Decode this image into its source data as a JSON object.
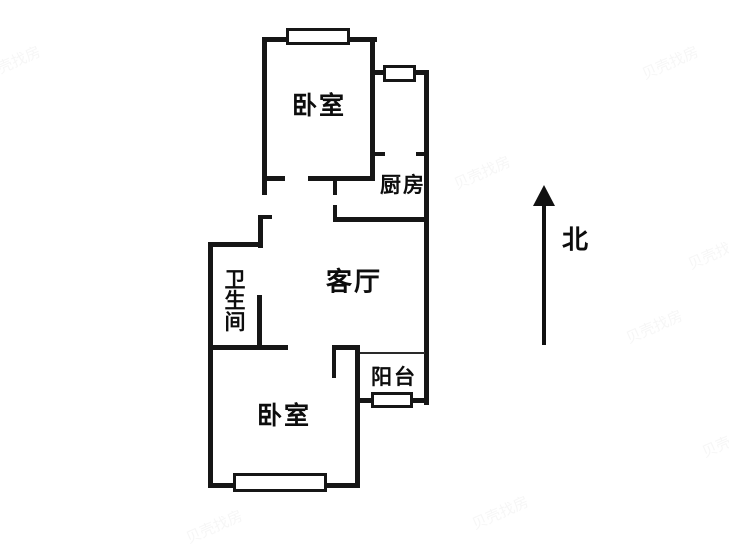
{
  "page": {
    "background_color": "#ffffff",
    "wall_color": "#161616",
    "width": 729,
    "height": 547
  },
  "floorplan": {
    "rooms": [
      {
        "id": "bedroom-north",
        "label": "卧室",
        "cx": 319,
        "cy": 106,
        "font_size": 25,
        "vertical": false
      },
      {
        "id": "kitchen",
        "label": "厨房",
        "cx": 403,
        "cy": 186,
        "font_size": 21,
        "vertical": false
      },
      {
        "id": "living-room",
        "label": "客厅",
        "cx": 354,
        "cy": 282,
        "font_size": 26,
        "vertical": false
      },
      {
        "id": "bathroom",
        "label": "卫生间",
        "cx": 233,
        "cy": 300,
        "font_size": 21,
        "vertical": true
      },
      {
        "id": "balcony",
        "label": "阳台",
        "cx": 394,
        "cy": 378,
        "font_size": 21,
        "vertical": false
      },
      {
        "id": "bedroom-south",
        "label": "卧室",
        "cx": 284,
        "cy": 416,
        "font_size": 25,
        "vertical": false
      }
    ],
    "walls": [
      {
        "x": 262,
        "y": 37,
        "w": 115,
        "h": 5
      },
      {
        "x": 262,
        "y": 37,
        "w": 5,
        "h": 158
      },
      {
        "x": 370,
        "y": 37,
        "w": 5,
        "h": 143
      },
      {
        "x": 372,
        "y": 70,
        "w": 57,
        "h": 5
      },
      {
        "x": 424,
        "y": 70,
        "w": 5,
        "h": 335
      },
      {
        "x": 375,
        "y": 152,
        "w": 10,
        "h": 4
      },
      {
        "x": 416,
        "y": 152,
        "w": 9,
        "h": 4
      },
      {
        "x": 262,
        "y": 176,
        "w": 23,
        "h": 5
      },
      {
        "x": 308,
        "y": 176,
        "w": 67,
        "h": 5
      },
      {
        "x": 333,
        "y": 181,
        "w": 4,
        "h": 14
      },
      {
        "x": 333,
        "y": 217,
        "w": 96,
        "h": 5
      },
      {
        "x": 333,
        "y": 205,
        "w": 4,
        "h": 12
      },
      {
        "x": 258,
        "y": 215,
        "w": 5,
        "h": 33
      },
      {
        "x": 258,
        "y": 215,
        "w": 14,
        "h": 4
      },
      {
        "x": 208,
        "y": 242,
        "w": 55,
        "h": 5
      },
      {
        "x": 208,
        "y": 242,
        "w": 5,
        "h": 246
      },
      {
        "x": 257,
        "y": 295,
        "w": 5,
        "h": 55
      },
      {
        "x": 208,
        "y": 345,
        "w": 80,
        "h": 5
      },
      {
        "x": 332,
        "y": 345,
        "w": 28,
        "h": 5
      },
      {
        "x": 332,
        "y": 350,
        "w": 4,
        "h": 28
      },
      {
        "x": 355,
        "y": 345,
        "w": 5,
        "h": 143
      },
      {
        "x": 355,
        "y": 398,
        "w": 74,
        "h": 5
      },
      {
        "x": 208,
        "y": 483,
        "w": 152,
        "h": 5
      }
    ],
    "thin_lines": [
      {
        "x": 360,
        "y": 352,
        "w": 65,
        "h": 2
      }
    ],
    "windows": [
      {
        "id": "window-bedroom-north",
        "x": 286,
        "y": 28,
        "w": 64,
        "h": 17
      },
      {
        "id": "window-kitchen",
        "x": 383,
        "y": 65,
        "w": 33,
        "h": 17
      },
      {
        "id": "window-balcony",
        "x": 371,
        "y": 392,
        "w": 42,
        "h": 16
      },
      {
        "id": "window-bedroom-south",
        "x": 233,
        "y": 473,
        "w": 94,
        "h": 19
      }
    ]
  },
  "compass": {
    "label": "北",
    "font_size": 26,
    "shaft": {
      "x": 542,
      "y": 200,
      "w": 4,
      "h": 145
    },
    "head": {
      "x": 533,
      "y": 185
    },
    "label_pos": {
      "x": 562,
      "y": 238
    }
  },
  "watermark": {
    "text": "贝壳找房",
    "positions": [
      {
        "x": 640,
        "y": 52
      },
      {
        "x": 686,
        "y": 242
      },
      {
        "x": 624,
        "y": 316
      },
      {
        "x": 452,
        "y": 162
      },
      {
        "x": 184,
        "y": 516
      },
      {
        "x": 470,
        "y": 502
      },
      {
        "x": -18,
        "y": 52
      },
      {
        "x": 700,
        "y": 430
      }
    ]
  }
}
